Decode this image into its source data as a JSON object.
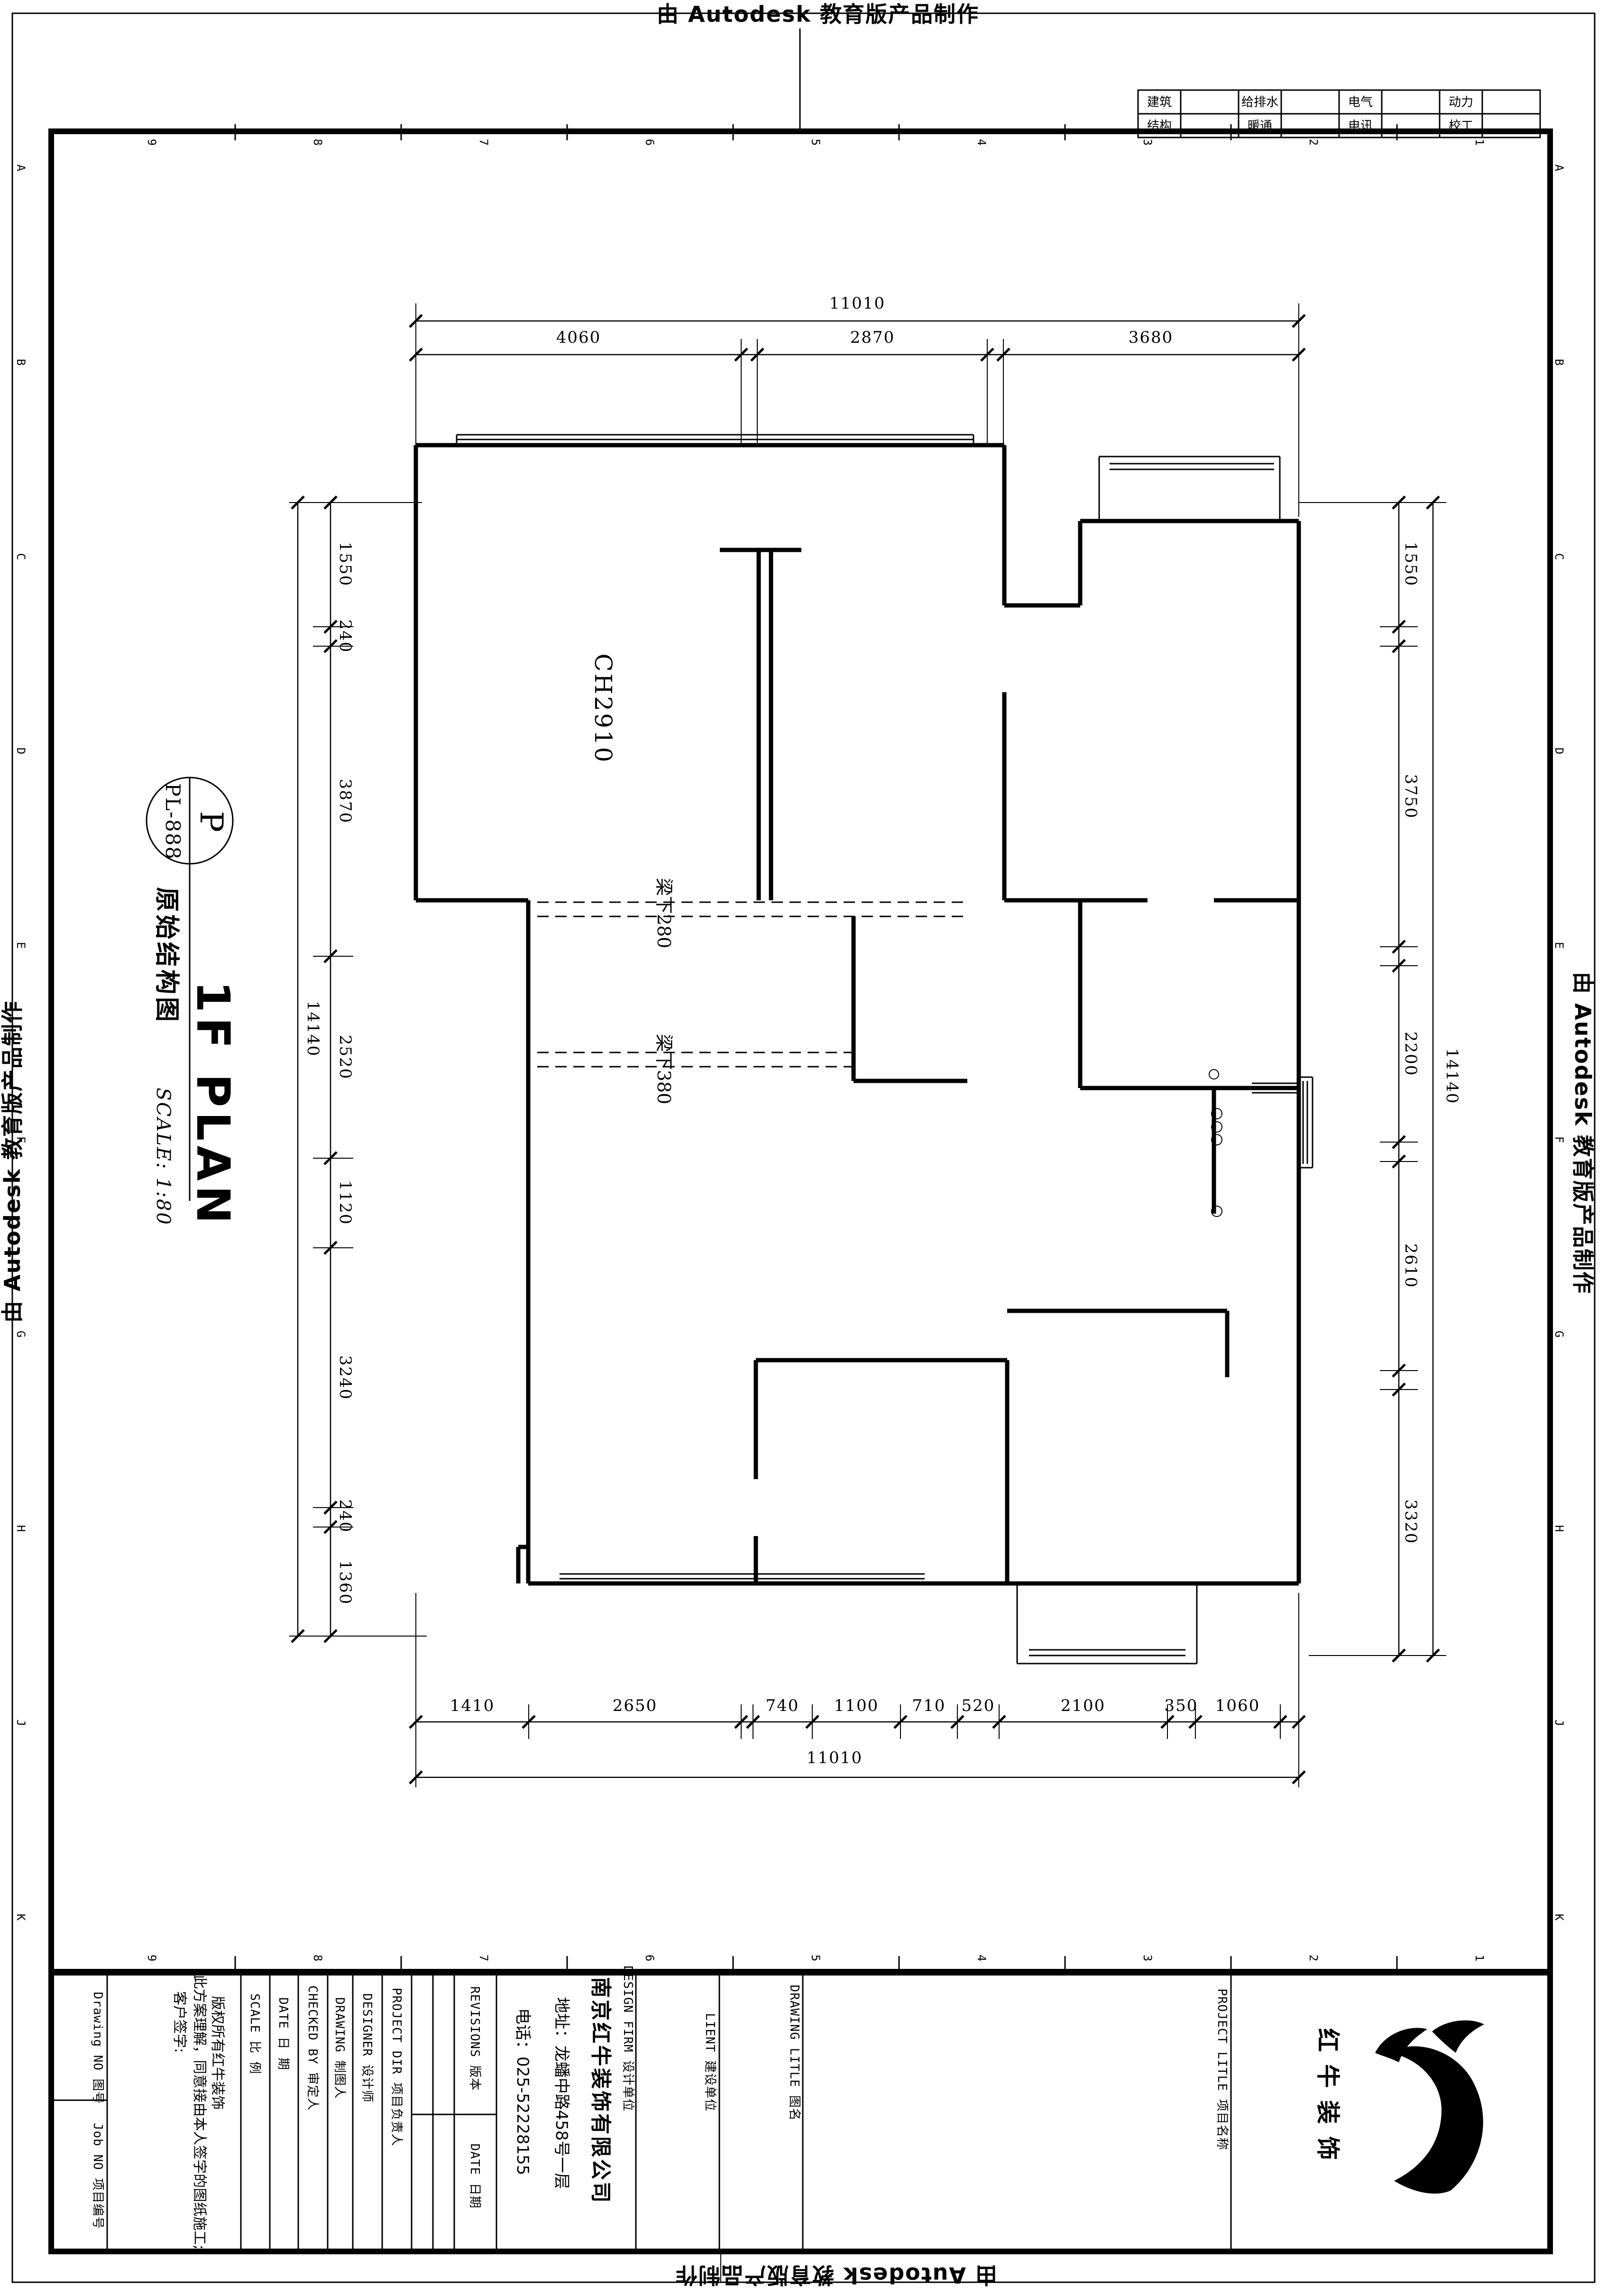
{
  "watermark": "由 Autodesk 教育版产品制作",
  "zones": {
    "numbers": [
      "9",
      "8",
      "7",
      "6",
      "5",
      "4",
      "3",
      "2",
      "1"
    ],
    "letters": [
      "A",
      "B",
      "C",
      "D",
      "E",
      "F",
      "G",
      "H",
      "J",
      "K"
    ]
  },
  "disciplines": {
    "row1": [
      "建筑",
      "给排水",
      "电气",
      "动力"
    ],
    "row2": [
      "结构",
      "暖通",
      "电讯",
      "校工"
    ]
  },
  "badge": {
    "tag": "P",
    "code": "PL-888",
    "name": "原始结构图",
    "title": "1F PLAN",
    "scale": "SCALE: 1:80"
  },
  "plan": {
    "ceiling": "CH2910",
    "beam_upper": "梁下280",
    "beam_lower": "梁下380"
  },
  "dims": {
    "top_total": "11010",
    "top": [
      "4060",
      "2870",
      "3680"
    ],
    "left_total": "14140",
    "left": [
      "1550",
      "240",
      "3870",
      "2520",
      "1120",
      "3240",
      "240",
      "1360"
    ],
    "right_total": "14140",
    "right": [
      "1550",
      "3750",
      "2200",
      "2610",
      "3320"
    ],
    "bottom_total": "11010",
    "bottom": [
      "1410",
      "2650",
      "740",
      "1100",
      "710",
      "520",
      "2100",
      "350",
      "1060"
    ]
  },
  "titleblock": {
    "drawing_no": "Drawing NO  图号",
    "job_no": "Job NO  项目编号",
    "copyright": [
      "版权所有红牛装饰",
      "此方案理解，同意接由本人签字的图纸施工;",
      "客户签字:"
    ],
    "scale": "SCALE    比 例",
    "date": "DATE    日 期",
    "checked_by": "CHECKED BY  审定人",
    "drawing_by": "DRAWING   制图人",
    "designer": "DESIGNER   设计师",
    "project_dir": "PROJECT DIR  项目负责人",
    "revisions": "REVISIONS  版本",
    "revision_date": "DATE 日期",
    "design_firm": "DESIGN FIRM  设计单位",
    "company": "南京红牛装饰有限公司",
    "address": "地址：龙蟠中路458号一层",
    "phone": "电话：025-52228155",
    "client": "LIENT  建设单位",
    "drawing_title": "DRAWING LITLE  图名",
    "project_title": "PROJECT LITLE  项目名称",
    "logo": "红牛装饰"
  }
}
